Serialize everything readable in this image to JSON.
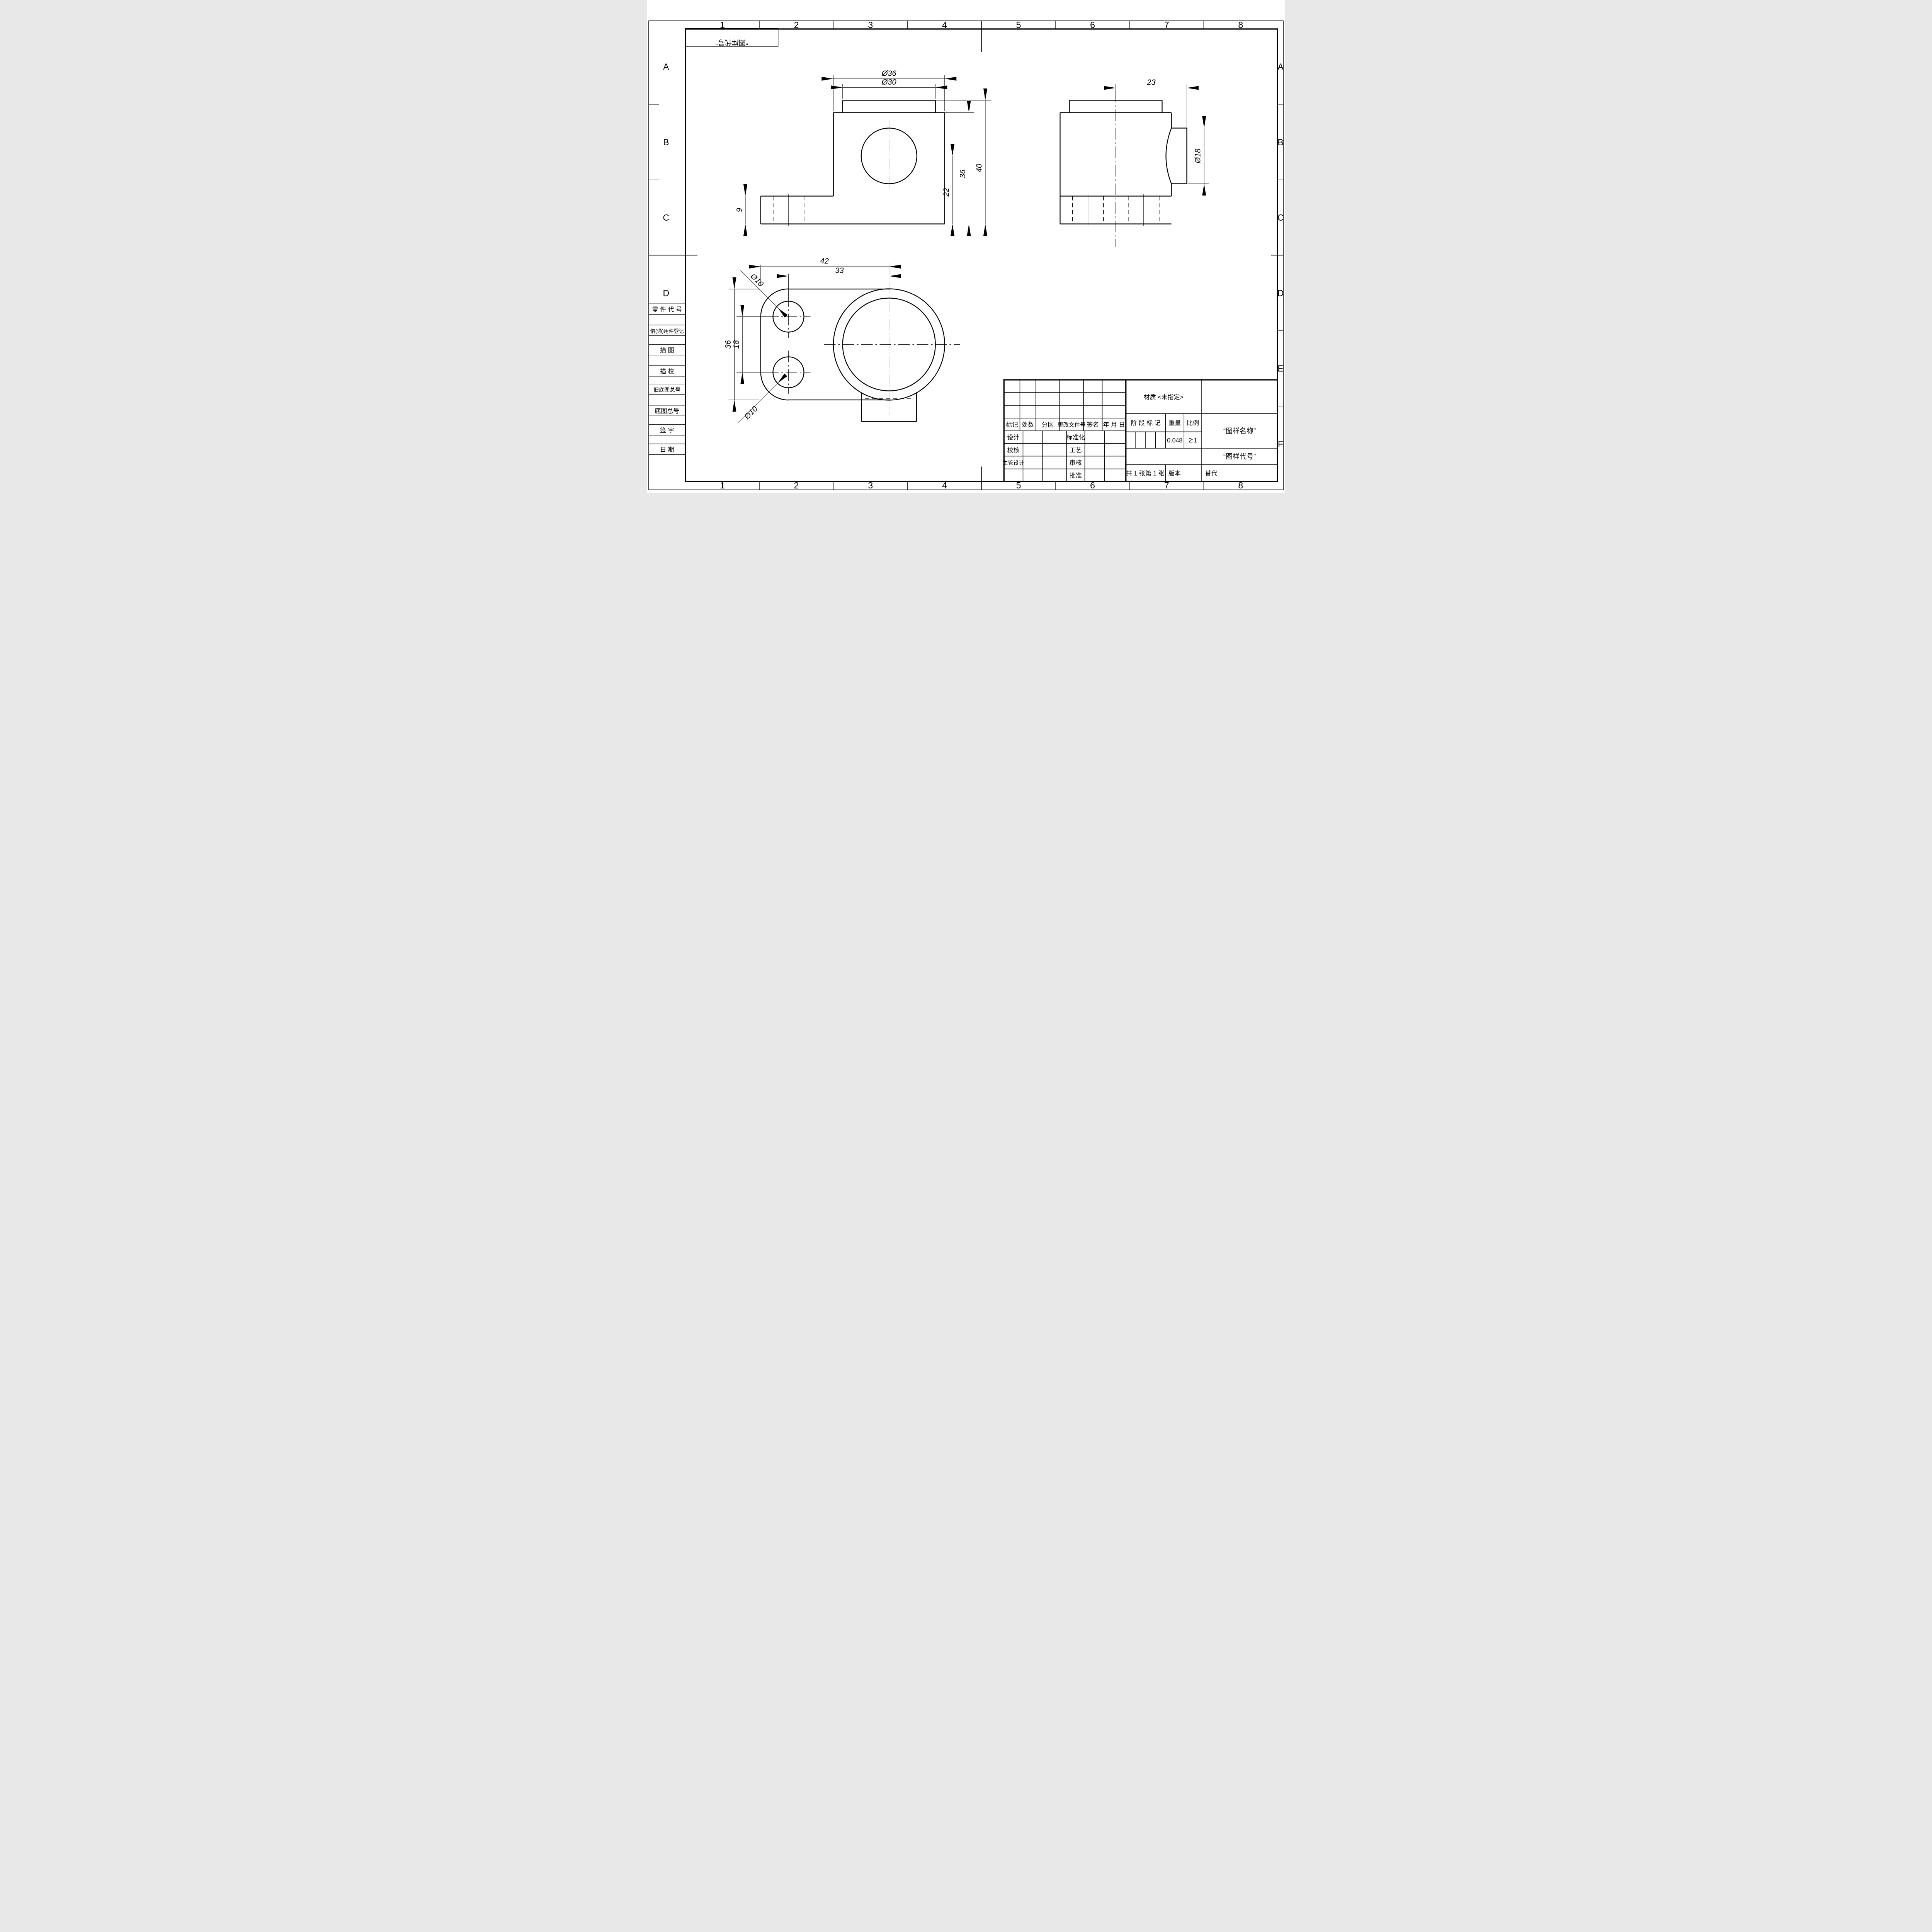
{
  "zones": {
    "cols": [
      "1",
      "2",
      "3",
      "4",
      "5",
      "6",
      "7",
      "8"
    ],
    "rows_left": [
      "A",
      "B",
      "C",
      "D"
    ],
    "rows_right": [
      "A",
      "B",
      "C",
      "D",
      "E",
      "F"
    ]
  },
  "mirror_box": {
    "text": "“图样代号”"
  },
  "sidebar": {
    "labels": [
      "零 件 代 号",
      "借(通)用件登记",
      "描 图",
      "描 校",
      "旧底图总号",
      "底图总号",
      "签 字",
      "日 期"
    ]
  },
  "dims": {
    "front": {
      "d36": "Ø36",
      "d30": "Ø30",
      "h40": "40",
      "h36": "36",
      "h22": "22",
      "base9": "9"
    },
    "side": {
      "w23": "23",
      "d18": "Ø18"
    },
    "plan": {
      "w42": "42",
      "w33": "33",
      "h36": "36",
      "h18": "18",
      "hole_top": "Ø10",
      "hole_bottom": "Ø10"
    }
  },
  "title_block": {
    "headers": {
      "mark": "标记",
      "count": "处数",
      "zone": "分区",
      "doc_no": "更改文件号",
      "sign": "签名",
      "date": "年 月 日"
    },
    "roles": {
      "design": "设计",
      "std": "标准化",
      "check": "校核",
      "process": "工艺",
      "chief": "主管设计",
      "audit": "审核",
      "approve": "批准"
    },
    "material": "材质 <未指定>",
    "stage_mark": "阶 段 标 记",
    "weight_label": "重量",
    "scale_label": "比例",
    "weight_value": "0.048",
    "scale_value": "2:1",
    "name": "“图样名称”",
    "code": "“图样代号”",
    "sheets": "共 1 张",
    "sheet_no": "第 1 张",
    "version": "版本",
    "replace": "替代"
  }
}
